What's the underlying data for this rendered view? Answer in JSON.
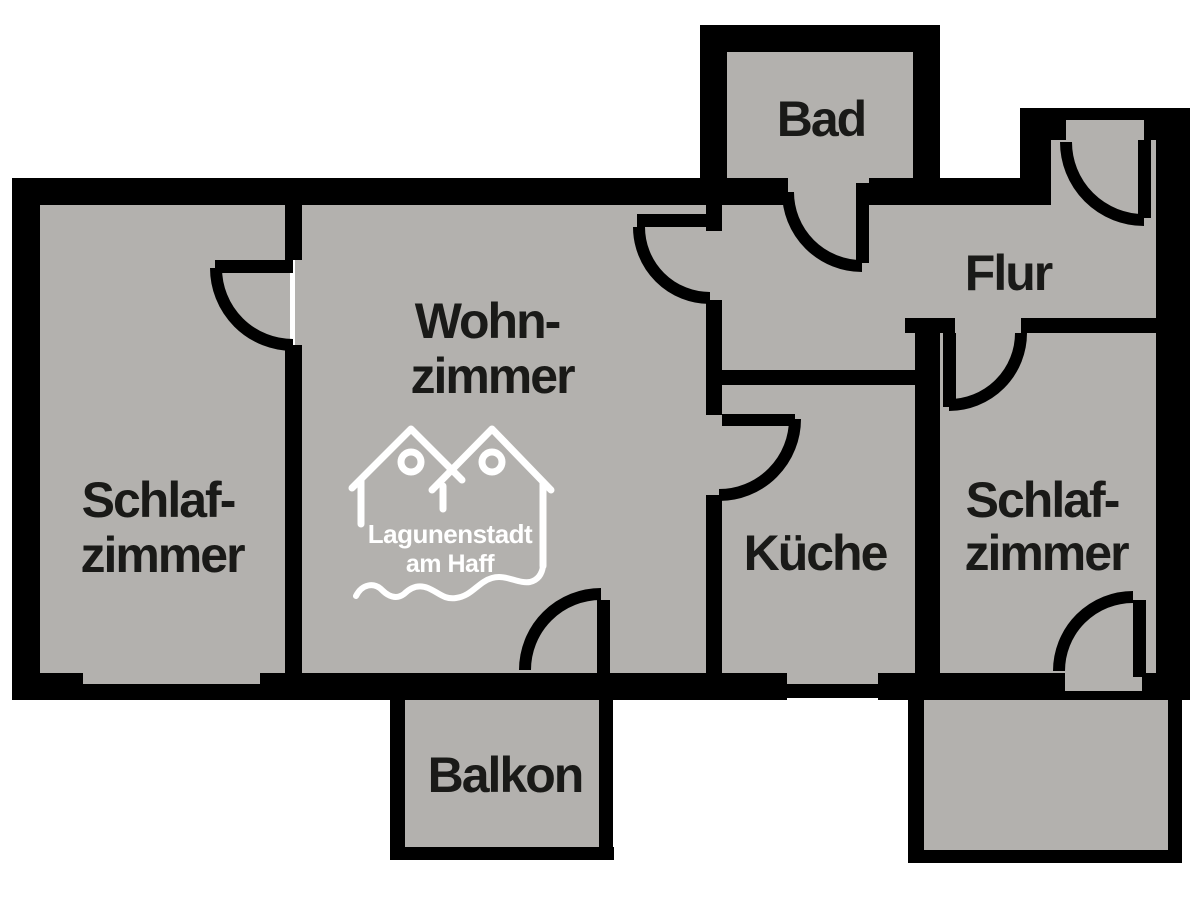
{
  "colors": {
    "background": "#ffffff",
    "floor": "#b3b1ae",
    "wall": "#000000",
    "label": "#1a1a18",
    "logo": "#ffffff"
  },
  "rooms": {
    "bad": {
      "label": "Bad"
    },
    "flur": {
      "label": "Flur"
    },
    "wohnzimmer": {
      "line1": "Wohn-",
      "line2": "zimmer"
    },
    "schlafzimmer_left": {
      "line1": "Schlaf-",
      "line2": "zimmer"
    },
    "kueche": {
      "label": "Küche"
    },
    "schlafzimmer_right": {
      "line1": "Schlaf-",
      "line2": "zimmer"
    },
    "balkon": {
      "label": "Balkon"
    }
  },
  "logo": {
    "line1": "Lagunenstadt",
    "line2": "am Haff"
  }
}
